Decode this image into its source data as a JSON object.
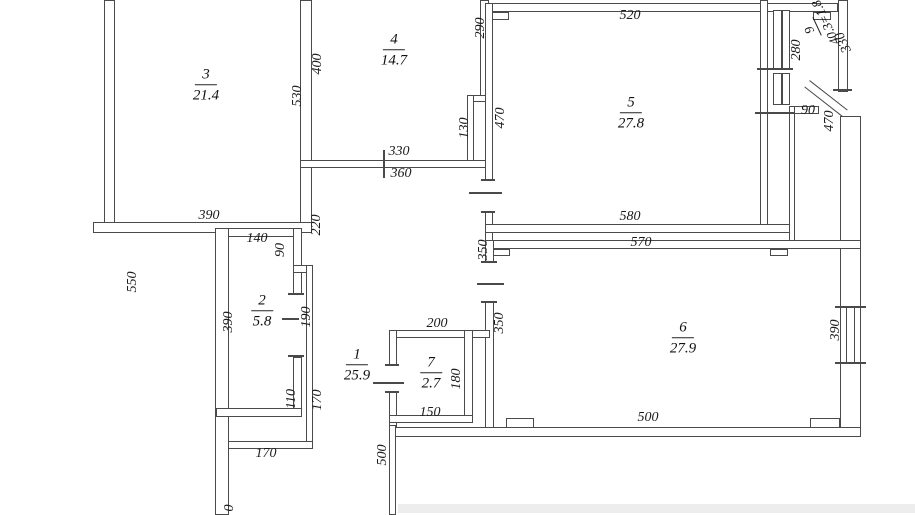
{
  "plan": {
    "type": "apartment-floor-plan",
    "line_color": "#4a4a4a",
    "background": "#ffffff",
    "rooms": [
      {
        "id": "room-3",
        "number": "3",
        "area": "21.4"
      },
      {
        "id": "room-4",
        "number": "4",
        "area": "14.7"
      },
      {
        "id": "room-5",
        "number": "5",
        "area": "27.8"
      },
      {
        "id": "room-6",
        "number": "6",
        "area": "27.9"
      },
      {
        "id": "room-2",
        "number": "2",
        "area": "5.8"
      },
      {
        "id": "room-1",
        "number": "1",
        "area": "25.9"
      },
      {
        "id": "room-7",
        "number": "7",
        "area": "2.7"
      },
      {
        "id": "balcony",
        "number": "9",
        "area": "40.3=1.8"
      }
    ],
    "dimensions": [
      {
        "value": "550"
      },
      {
        "value": "530"
      },
      {
        "value": "390"
      },
      {
        "value": "400"
      },
      {
        "value": "290"
      },
      {
        "value": "130"
      },
      {
        "value": "330"
      },
      {
        "value": "360"
      },
      {
        "value": "520"
      },
      {
        "value": "470"
      },
      {
        "value": "470"
      },
      {
        "value": "580"
      },
      {
        "value": "280"
      },
      {
        "value": "330"
      },
      {
        "value": "90"
      },
      {
        "value": "570"
      },
      {
        "value": "350"
      },
      {
        "value": "350"
      },
      {
        "value": "390"
      },
      {
        "value": "500"
      },
      {
        "value": "140"
      },
      {
        "value": "90"
      },
      {
        "value": "390"
      },
      {
        "value": "190"
      },
      {
        "value": "110"
      },
      {
        "value": "170"
      },
      {
        "value": "170"
      },
      {
        "value": "0"
      },
      {
        "value": "200"
      },
      {
        "value": "180"
      },
      {
        "value": "150"
      },
      {
        "value": "500"
      },
      {
        "value": "220"
      }
    ]
  }
}
